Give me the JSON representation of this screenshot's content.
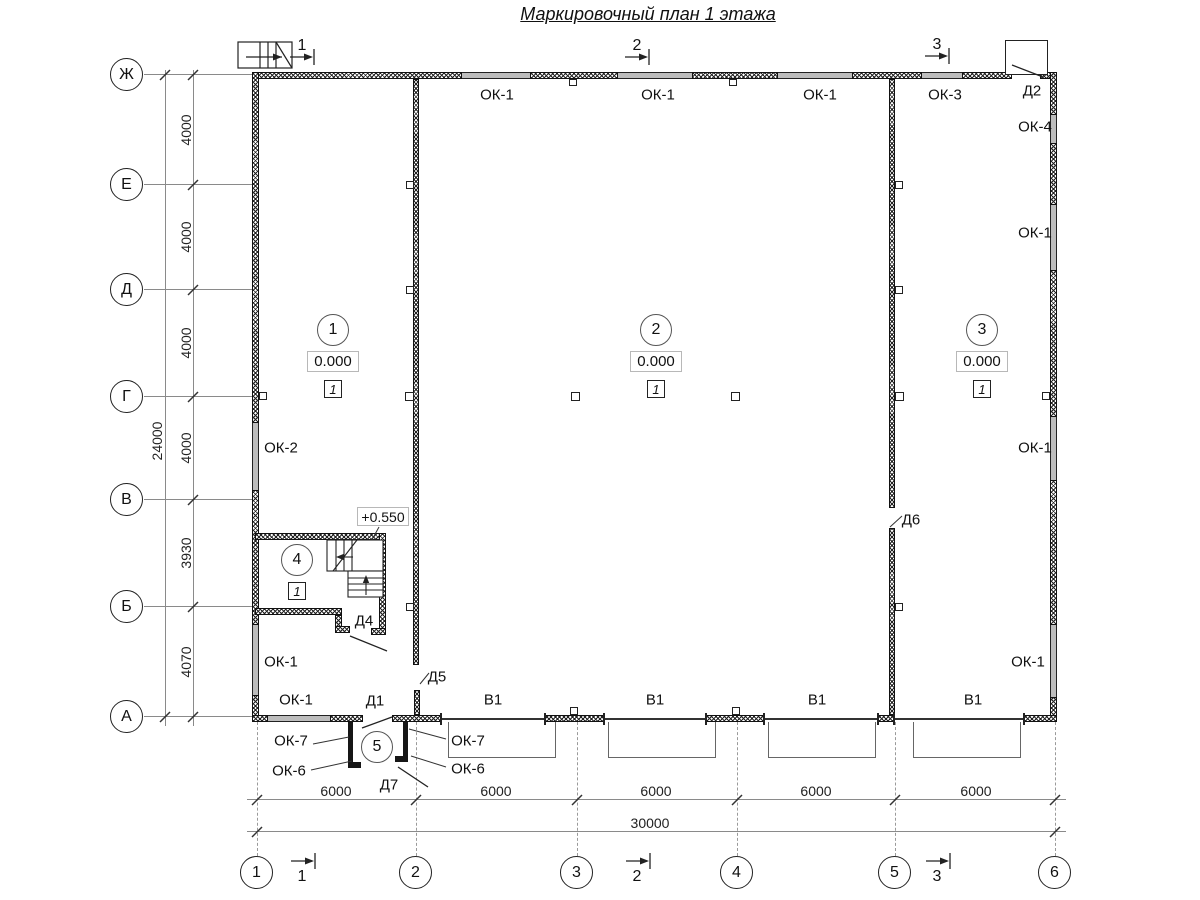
{
  "title": "Маркировочный план 1 этажа",
  "grid": {
    "row_axes": [
      "Ж",
      "Е",
      "Д",
      "Г",
      "В",
      "Б",
      "А"
    ],
    "col_axes": [
      "1",
      "2",
      "3",
      "4",
      "5",
      "6"
    ]
  },
  "dims": {
    "left": [
      "4000",
      "4000",
      "4000",
      "4000",
      "3930",
      "4070"
    ],
    "left_total": "24000",
    "bottom": [
      "6000",
      "6000",
      "6000",
      "6000",
      "6000"
    ],
    "bottom_total": "30000"
  },
  "sections": {
    "s1": "1",
    "s2": "2",
    "s3": "3"
  },
  "rooms": {
    "r1": {
      "num": "1",
      "elev": "0.000",
      "type": "1"
    },
    "r2": {
      "num": "2",
      "elev": "0.000",
      "type": "1"
    },
    "r3": {
      "num": "3",
      "elev": "0.000",
      "type": "1"
    },
    "r4": {
      "num": "4",
      "type": "1"
    },
    "r5": {
      "num": "5"
    }
  },
  "stair_elev": "+0.550",
  "marks": {
    "ok1": "ОК-1",
    "ok2": "ОК-2",
    "ok3": "ОК-3",
    "ok4": "ОК-4",
    "ok6": "ОК-6",
    "ok7": "ОК-7",
    "d1": "Д1",
    "d2": "Д2",
    "d4": "Д4",
    "d5": "Д5",
    "d6": "Д6",
    "d7": "Д7",
    "v1": "В1"
  }
}
